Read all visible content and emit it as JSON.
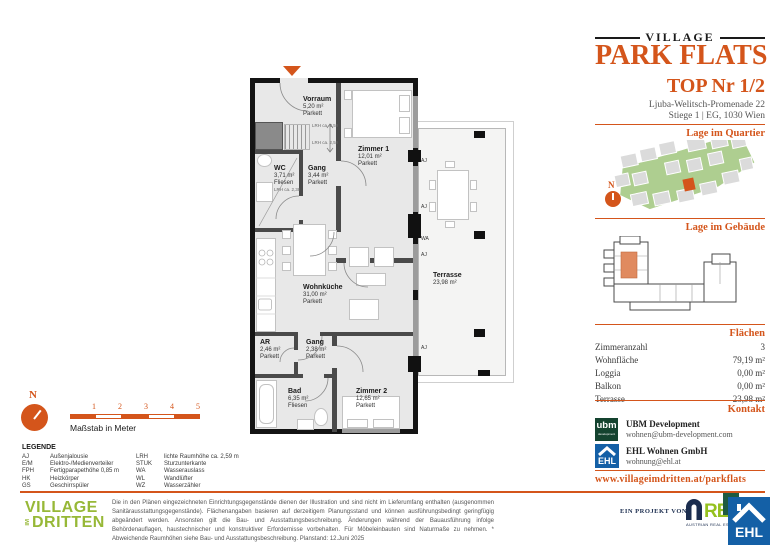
{
  "header": {
    "brand_top": "VILLAGE",
    "brand_main": "PARK FLATS",
    "unit_title": "TOP Nr 1/2",
    "address_line1": "Ljuba-Welitsch-Promenade 22",
    "address_line2": "Stiege 1 | EG, 1030 Wien"
  },
  "sections": {
    "quartier": "Lage im Quartier",
    "gebaeude": "Lage im Gebäude",
    "flaechen": "Flächen",
    "kontakt": "Kontakt"
  },
  "compass_n": "N",
  "areas": {
    "rows": [
      {
        "label": "Zimmeranzahl",
        "value": "3"
      },
      {
        "label": "Wohnfläche",
        "value": "79,19 m²"
      },
      {
        "label": "Loggia",
        "value": "0,00 m²"
      },
      {
        "label": "Balkon",
        "value": "0,00 m²"
      },
      {
        "label": "Terrasse",
        "value": "23,98 m²"
      }
    ]
  },
  "contact": {
    "ubm_logo": "ubm",
    "ubm_logo_sub": "development",
    "ubm_name": "UBM Development",
    "ubm_email": "wohnen@ubm-development.com",
    "ehl_logo": "EHL",
    "ehl_name": "EHL Wohnen GmbH",
    "ehl_email": "wohnung@ehl.at",
    "website": "www.villageimdritten.at/parkflats"
  },
  "plan": {
    "rooms": [
      {
        "name": "Vorraum",
        "area": "5,20 m²",
        "floor": "Parkett"
      },
      {
        "name": "Zimmer 1",
        "area": "12,01 m²",
        "floor": "Parkett"
      },
      {
        "name": "WC",
        "area": "3,71 m²",
        "floor": "Fliesen",
        "note": "LRH ca. 2,38"
      },
      {
        "name": "Gang",
        "area": "3,44 m²",
        "floor": "Parkett"
      },
      {
        "name": "Wohnküche",
        "area": "31,00 m²",
        "floor": "Parkett"
      },
      {
        "name": "AR",
        "area": "2,46 m²",
        "floor": "Parkett"
      },
      {
        "name": "Gang",
        "area": "2,38 m²",
        "floor": "Parkett"
      },
      {
        "name": "Bad",
        "area": "6,35 m²",
        "floor": "Fliesen"
      },
      {
        "name": "Zimmer 2",
        "area": "12,65 m²",
        "floor": "Parkett"
      },
      {
        "name": "Terrasse",
        "area": "23,98 m²"
      }
    ],
    "aj": "AJ",
    "wa": "WA",
    "lrh_note_1": "LRH ca. 2,59",
    "lrh_note_2": "LRH ca. 2,59"
  },
  "scalebar": {
    "ticks": [
      "1",
      "2",
      "3",
      "4",
      "5"
    ],
    "caption": "Maßstab in Meter"
  },
  "legend": {
    "title": "LEGENDE",
    "col1": [
      {
        "abbr": "AJ",
        "desc": "Außenjalousie"
      },
      {
        "abbr": "E/M",
        "desc": "Elektro-/Medienverteiler"
      },
      {
        "abbr": "FPH",
        "desc": "Fertigparapethöhe 0,85 m"
      },
      {
        "abbr": "HK",
        "desc": "Heizkörper"
      },
      {
        "abbr": "GS",
        "desc": "Geschirrspüler"
      }
    ],
    "col2": [
      {
        "abbr": "LRH",
        "desc": "lichte Raumhöhe ca. 2,59 m"
      },
      {
        "abbr": "STUK",
        "desc": "Sturzunterkante"
      },
      {
        "abbr": "WA",
        "desc": "Wasserauslass"
      },
      {
        "abbr": "WL",
        "desc": "Wandlüfter"
      },
      {
        "abbr": "WZ",
        "desc": "Wasserzähler"
      }
    ]
  },
  "footer": {
    "village_line1": "VILLAGE",
    "village_im": "IM",
    "village_line2": "DRITTEN",
    "disclaimer": "Die in den Plänen eingezeichneten Einrichtungsgegenstände dienen der Illustration und sind nicht im Lieferumfang enthalten (ausgenommen Sanitärausstattungsgegenstände). Flächenangaben basieren auf derzeitigem Planungsstand und können ausführungsbedingt geringfügig abgeändert werden. Ansonsten gilt die Bau- und Ausstattungsbeschreibung. Änderungen während der Bauausführung infolge Behördenauflagen, haustechnischer und konstruktiver Erfordernisse vorbehalten. Für Möbeleinbauten sind Naturmaße zu nehmen. * Abweichende Raumhöhen siehe Bau- und Ausstattungsbeschreibung. Planstand: 12.Juni 2025",
    "project_label": "EIN PROJEKT VON",
    "are_text": "RE",
    "are_sub": "AUSTRIAN REAL ESTATE",
    "ehl_text": "EHL"
  }
}
